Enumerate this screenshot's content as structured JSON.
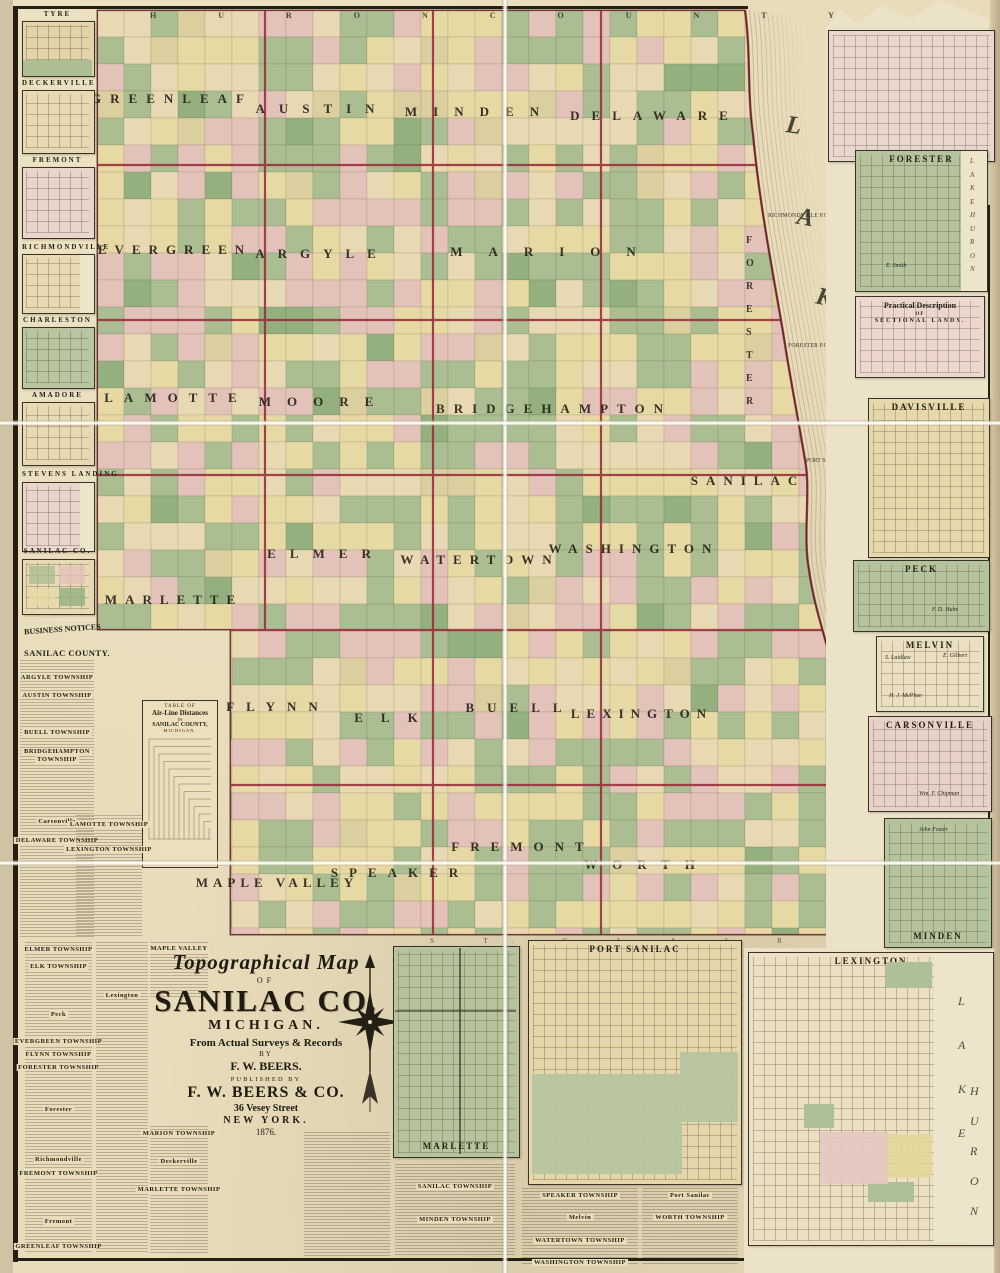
{
  "title_block": {
    "l1": "Topographical Map",
    "l2": "OF",
    "l3": "SANILAC CO.",
    "l4": "MICHIGAN.",
    "l5": "From Actual Surveys & Records",
    "l6": "BY",
    "l7": "F. W. BEERS.",
    "l8": "PUBLISHED BY",
    "l9": "F. W. BEERS & CO.",
    "l10": "36 Vesey Street",
    "l11": "NEW YORK.",
    "l12": "1876."
  },
  "neighbors": {
    "top": "H U R O N      C O U N T Y",
    "bottom": "S T.   C L A I R    C O."
  },
  "business": {
    "header": "BUSINESS NOTICES",
    "sub": "SANILAC COUNTY."
  },
  "distance_table": {
    "l1": "TABLE OF",
    "l2": "Air-Line Distances",
    "l3": "IN",
    "l4": "SANILAC COUNTY,",
    "l5": "MICHIGAN."
  },
  "lake": {
    "name": "LAKE HURON",
    "letters": [
      {
        "ch": "L",
        "x": 786,
        "y": 112
      },
      {
        "ch": "A",
        "x": 797,
        "y": 204
      },
      {
        "ch": "K",
        "x": 816,
        "y": 284
      },
      {
        "ch": "E",
        "x": 838,
        "y": 363
      },
      {
        "ch": "H",
        "x": 856,
        "y": 505
      },
      {
        "ch": "U",
        "x": 855,
        "y": 596
      },
      {
        "ch": "R",
        "x": 861,
        "y": 686
      },
      {
        "ch": "O",
        "x": 866,
        "y": 782
      },
      {
        "ch": "N",
        "x": 871,
        "y": 866
      }
    ]
  },
  "vertical_township": {
    "name": "FORESTER",
    "x": 746,
    "y": 235
  },
  "shore_labels": [
    {
      "t": "RICHMONDVILLE P.O.",
      "x": 768,
      "y": 213
    },
    {
      "t": "FORESTER P.O.",
      "x": 788,
      "y": 343
    },
    {
      "t": "PORT SANILAC P.O.",
      "x": 806,
      "y": 458
    }
  ],
  "townships": [
    {
      "n": "GREENLEAF",
      "x": 172,
      "y": 99,
      "ls": 9
    },
    {
      "n": "AUSTIN",
      "x": 322,
      "y": 109,
      "ls": 14
    },
    {
      "n": "MINDEN",
      "x": 480,
      "y": 112,
      "ls": 16
    },
    {
      "n": "DELAWARE",
      "x": 655,
      "y": 116,
      "ls": 12
    },
    {
      "n": "EVERGREEN",
      "x": 175,
      "y": 250,
      "ls": 8
    },
    {
      "n": "ARGYLE",
      "x": 322,
      "y": 254,
      "ls": 13
    },
    {
      "n": "MARION",
      "x": 556,
      "y": 252,
      "ls": 26
    },
    {
      "n": "LAMOTTE",
      "x": 176,
      "y": 398,
      "ls": 11
    },
    {
      "n": "MOORE",
      "x": 324,
      "y": 402,
      "ls": 16
    },
    {
      "n": "BRIDGEHAMPTON",
      "x": 554,
      "y": 409,
      "ls": 9
    },
    {
      "n": "SANILAC",
      "x": 748,
      "y": 481,
      "ls": 8
    },
    {
      "n": "MARLETTE",
      "x": 174,
      "y": 600,
      "ls": 8
    },
    {
      "n": "ELMER",
      "x": 326,
      "y": 554,
      "ls": 14
    },
    {
      "n": "WATERTOWN",
      "x": 480,
      "y": 560,
      "ls": 8
    },
    {
      "n": "WASHINGTON",
      "x": 634,
      "y": 549,
      "ls": 8
    },
    {
      "n": "FLYNN",
      "x": 278,
      "y": 707,
      "ls": 12
    },
    {
      "n": "ELK",
      "x": 395,
      "y": 718,
      "ls": 18
    },
    {
      "n": "BUELL",
      "x": 520,
      "y": 708,
      "ls": 13
    },
    {
      "n": "LEXINGTON",
      "x": 642,
      "y": 714,
      "ls": 7
    },
    {
      "n": "FREMONT",
      "x": 523,
      "y": 847,
      "ls": 11
    },
    {
      "n": "MAPLE VALLEY",
      "x": 277,
      "y": 883,
      "ls": 5
    },
    {
      "n": "SPEAKER",
      "x": 400,
      "y": 873,
      "ls": 11
    },
    {
      "n": "WORTH",
      "x": 647,
      "y": 865,
      "ls": 15
    }
  ],
  "margin_notes": [
    {
      "t": "Sheet 1.",
      "y": 170
    },
    {
      "t": "Sheet 3.",
      "y": 640
    },
    {
      "t": "Sheet 4.",
      "y": 1085
    }
  ],
  "left_insets": [
    {
      "t": "TYRE",
      "ty": 10,
      "by": 21,
      "h": 54,
      "c": "#e2d4a8",
      "extra": "greenstrip"
    },
    {
      "t": "DECKERVILLE",
      "ty": 79,
      "by": 90,
      "h": 62,
      "c": "#e7dab3",
      "extra": ""
    },
    {
      "t": "FREMONT",
      "ty": 156,
      "by": 167,
      "h": 70,
      "c": "#e9d5cc",
      "extra": ""
    },
    {
      "t": "RICHMONDVILLE",
      "ty": 243,
      "by": 254,
      "h": 58,
      "c": "#e7dab3",
      "extra": "shore"
    },
    {
      "t": "CHARLESTON",
      "ty": 316,
      "by": 327,
      "h": 60,
      "c": "#b8c6a1",
      "extra": ""
    },
    {
      "t": "AMADORE",
      "ty": 391,
      "by": 402,
      "h": 62,
      "c": "#e7dab3",
      "extra": ""
    },
    {
      "t": "STEVENS LANDING",
      "ty": 470,
      "by": 482,
      "h": 68,
      "c": "#e9d5cc",
      "extra": "shore"
    },
    {
      "t": "SANILAC CO.",
      "ty": 547,
      "by": 559,
      "h": 54,
      "c": "#e7dab3",
      "extra": "patch"
    }
  ],
  "sidebar_notices": [
    {
      "x": 20,
      "w": 74,
      "top": 660,
      "h": 278,
      "items": [
        [
          "ARGYLE TOWNSHIP",
          674
        ],
        [
          "AUSTIN TOWNSHIP",
          692
        ],
        [
          "BUELL TOWNSHIP",
          729
        ],
        [
          "BRIDGEHAMPTON",
          748
        ],
        [
          "TOWNSHIP",
          756
        ],
        [
          "Carsonville",
          818
        ],
        [
          "DELAWARE TOWNSHIP",
          837
        ]
      ]
    },
    {
      "x": 76,
      "w": 66,
      "top": 815,
      "h": 122,
      "items": [
        [
          "LAMOTTE TOWNSHIP",
          821
        ],
        [
          "LEXINGTON TOWNSHIP",
          846
        ]
      ]
    }
  ],
  "bottom_notices": [
    {
      "x": 25,
      "w": 67,
      "top": 942,
      "h": 311,
      "items": [
        [
          "ELMER TOWNSHIP",
          946
        ],
        [
          "ELK TOWNSHIP",
          963
        ],
        [
          "Peck",
          1011
        ],
        [
          "EVERGREEN TOWNSHIP",
          1038
        ],
        [
          "FLYNN TOWNSHIP",
          1051
        ],
        [
          "FORESTER TOWNSHIP",
          1064
        ],
        [
          "Forester",
          1106
        ],
        [
          "Richmondville",
          1156
        ],
        [
          "FREMONT TOWNSHIP",
          1170
        ],
        [
          "Fremont",
          1218
        ],
        [
          "GREENLEAF TOWNSHIP",
          1243
        ]
      ]
    },
    {
      "x": 96,
      "w": 52,
      "top": 942,
      "h": 311,
      "items": [
        [
          "Lexington",
          992
        ]
      ]
    },
    {
      "x": 150,
      "w": 58,
      "top": 942,
      "h": 56,
      "items": [
        [
          "MAPLE VALLEY",
          945
        ]
      ]
    },
    {
      "x": 150,
      "w": 58,
      "top": 1126,
      "h": 127,
      "items": [
        [
          "MARION TOWNSHIP",
          1130
        ],
        [
          "Deckerville",
          1158
        ],
        [
          "MARLETTE TOWNSHIP",
          1186
        ]
      ]
    },
    {
      "x": 304,
      "w": 86,
      "top": 1132,
      "h": 124,
      "items": []
    },
    {
      "x": 395,
      "w": 120,
      "top": 1164,
      "h": 92,
      "items": [
        [
          "SANILAC TOWNSHIP",
          1183
        ],
        [
          "MINDEN TOWNSHIP",
          1216
        ]
      ]
    },
    {
      "x": 522,
      "w": 116,
      "top": 1188,
      "h": 78,
      "items": [
        [
          "SPEAKER TOWNSHIP",
          1192
        ],
        [
          "Melvin",
          1214
        ],
        [
          "WATERTOWN TOWNSHIP",
          1237
        ],
        [
          "WASHINGTON TOWNSHIP",
          1259
        ]
      ]
    },
    {
      "x": 642,
      "w": 96,
      "top": 1188,
      "h": 78,
      "items": [
        [
          "Port Sanilac",
          1192
        ],
        [
          "WORTH TOWNSHIP",
          1214
        ]
      ]
    }
  ],
  "right_insets": [
    {
      "t": "",
      "x": 828,
      "y": 30,
      "w": 167,
      "h": 132,
      "c": "#e9d6cd",
      "pos": "none",
      "names": [],
      "lake": ""
    },
    {
      "t": "FORESTER",
      "x": 855,
      "y": 150,
      "w": 133,
      "h": 142,
      "c": "#b6c49e",
      "pos": "top",
      "names": [
        {
          "t": "E. Smith",
          "rx": 30,
          "ry": 112
        }
      ],
      "lake": "LAKE HURON"
    },
    {
      "t": "Practical Description",
      "t2": "OF",
      "t3": "SECTIONAL LANDS.",
      "x": 855,
      "y": 296,
      "w": 130,
      "h": 82,
      "c": "#ecd6ce",
      "pos": "plines",
      "names": [],
      "lake": ""
    },
    {
      "t": "DAVISVILLE",
      "x": 868,
      "y": 398,
      "w": 122,
      "h": 160,
      "c": "#e6d8ab",
      "pos": "top",
      "names": [],
      "lake": ""
    },
    {
      "t": "PECK",
      "x": 853,
      "y": 560,
      "w": 137,
      "h": 72,
      "c": "#b6c49e",
      "pos": "top",
      "names": [
        {
          "t": "F. D. Hube",
          "rx": 78,
          "ry": 46
        }
      ],
      "lake": ""
    },
    {
      "t": "MELVIN",
      "x": 876,
      "y": 636,
      "w": 108,
      "h": 76,
      "c": "#eadfc0",
      "pos": "top",
      "names": [
        {
          "t": "S. Laidlaw",
          "rx": 8,
          "ry": 18
        },
        {
          "t": "E. Gilbert",
          "rx": 66,
          "ry": 16
        },
        {
          "t": "H. J. McPhee",
          "rx": 12,
          "ry": 56
        }
      ],
      "lake": ""
    },
    {
      "t": "CARSONVILLE",
      "x": 868,
      "y": 716,
      "w": 124,
      "h": 96,
      "c": "#e8d2c8",
      "pos": "top",
      "names": [
        {
          "t": "Wm. F. Chipman",
          "rx": 50,
          "ry": 74
        }
      ],
      "lake": ""
    },
    {
      "t": "MINDEN",
      "x": 884,
      "y": 818,
      "w": 108,
      "h": 130,
      "c": "#b6c49e",
      "pos": "bottom-in",
      "names": [
        {
          "t": "John Foster",
          "rx": 34,
          "ry": 8
        }
      ],
      "lake": ""
    }
  ],
  "bottom_insets": [
    {
      "t": "MARLETTE",
      "x": 393,
      "y": 946,
      "w": 127,
      "h": 212,
      "c": "#b7c39c",
      "pos": "bottom-in",
      "lake": ""
    },
    {
      "t": "PORT SANILAC",
      "x": 528,
      "y": 940,
      "w": 214,
      "h": 245,
      "c": "#e6d7ab",
      "pos": "top",
      "lake": ""
    },
    {
      "t": "LEXINGTON",
      "x": 748,
      "y": 952,
      "w": 246,
      "h": 294,
      "c": "#ecdfc2",
      "pos": "top",
      "lake": "LAKE HURON"
    }
  ],
  "map_palette": [
    "#aabe91",
    "#e3c2ba",
    "#e6d9a4",
    "#e8d9b2",
    "#93b07e",
    "#dccf9f"
  ],
  "border_color": "#9a2f3e"
}
